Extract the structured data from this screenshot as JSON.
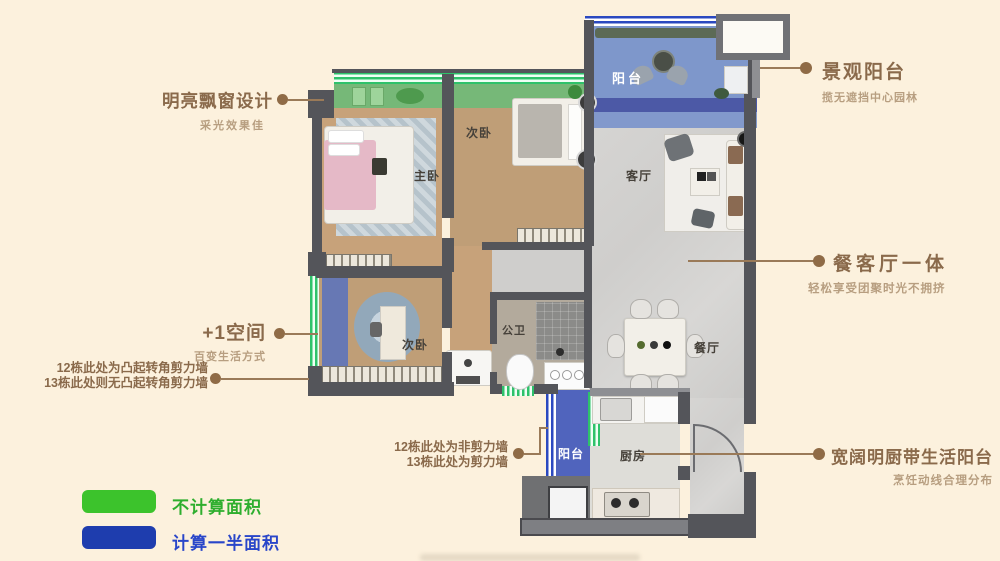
{
  "page": {
    "background": "#fcf1dd"
  },
  "rooms": {
    "balcony_top": "阳台",
    "bedroom_second": "次卧",
    "master_bedroom": "主卧",
    "living_room": "客厅",
    "bathroom": "公卫",
    "dining_room": "餐厅",
    "bedroom_plus": "次卧",
    "kitchen": "厨房",
    "balcony_bottom": "阳台"
  },
  "callouts": {
    "left": [
      {
        "title": "明亮飘窗设计",
        "subtitle": "采光效果佳"
      },
      {
        "title": "+1空间",
        "subtitle": "百变生活方式"
      }
    ],
    "left_notes": [
      {
        "line1": "12栋此处为凸起转角剪力墙",
        "line2": "13栋此处则无凸起转角剪力墙"
      },
      {
        "line1": "12栋此处为非剪力墙",
        "line2": "13栋此处为剪力墙"
      }
    ],
    "right": [
      {
        "title": "景观阳台",
        "subtitle": "揽无遮挡中心园林"
      },
      {
        "title": "餐客厅一体",
        "subtitle": "轻松享受团聚时光不拥挤"
      },
      {
        "title": "宽阔明厨带生活阳台",
        "subtitle": "烹饪动线合理分布"
      }
    ]
  },
  "legend": {
    "items": [
      {
        "label": "不计算面积",
        "swatch_color": "#3cc32c",
        "label_color": "#2eae2e"
      },
      {
        "label": "计算一半面积",
        "swatch_color": "#1e3dae",
        "label_color": "#2946c9"
      }
    ]
  },
  "colors": {
    "accent_text_brown": "#8a6a4b",
    "subtitle_text_brown": "#b79e80",
    "no_area_green": "#3cc32c",
    "half_area_blue": "#1e3dae",
    "wall_dark": "#54555a"
  }
}
